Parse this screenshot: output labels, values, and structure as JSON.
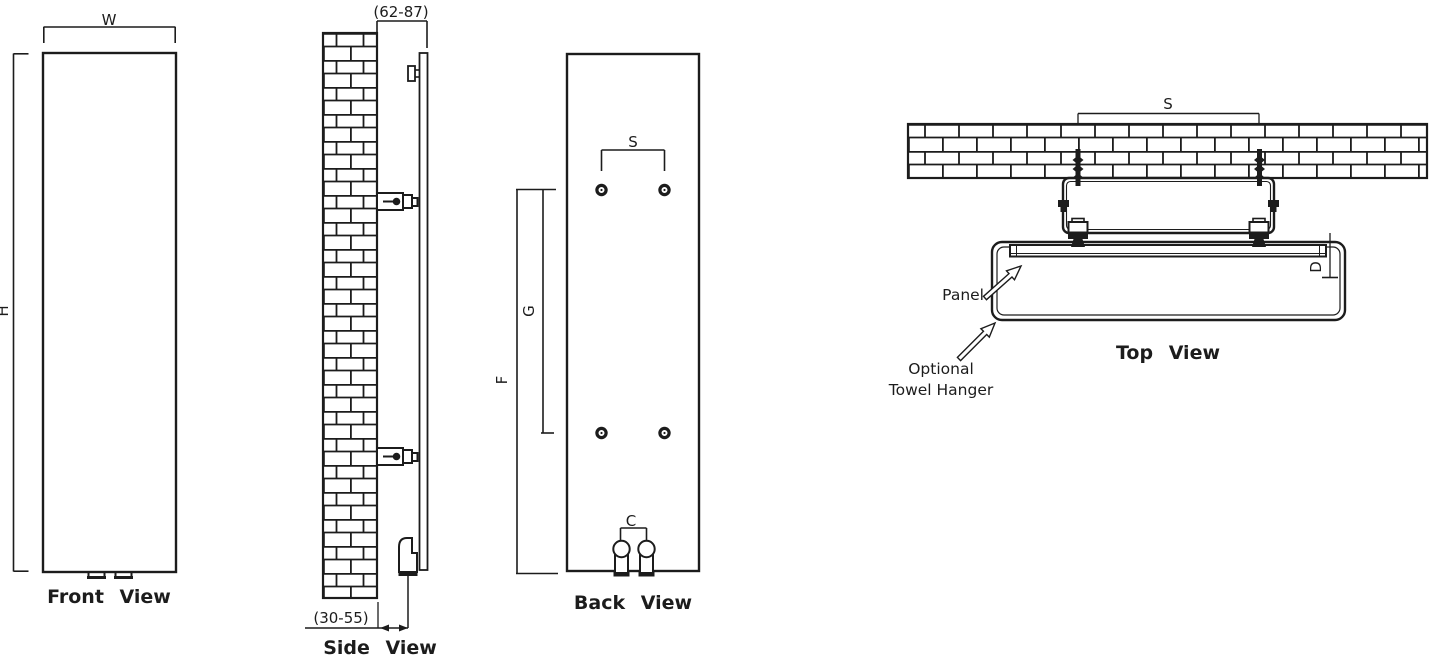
{
  "diagram": {
    "background": "#ffffff",
    "line_color": "#1c1c1c",
    "front_view": {
      "title": "Front View",
      "dim_width": "W",
      "dim_height": "H"
    },
    "side_view": {
      "title": "Side View",
      "dim_wall_to_panel_top": "(62-87)",
      "dim_wall_to_pipe_bottom": "(30-55)"
    },
    "back_view": {
      "title": "Back View",
      "dim_bracket_span": "S",
      "dim_bracket_spacing": "G",
      "dim_bracket_to_bottom": "F",
      "dim_pipe_centres": "C"
    },
    "top_view": {
      "title": "Top View",
      "dim_bracket_span": "S",
      "dim_depth": "D",
      "label_panel": "Panel",
      "label_hanger_line1": "Optional",
      "label_hanger_line2": "Towel Hanger"
    }
  }
}
